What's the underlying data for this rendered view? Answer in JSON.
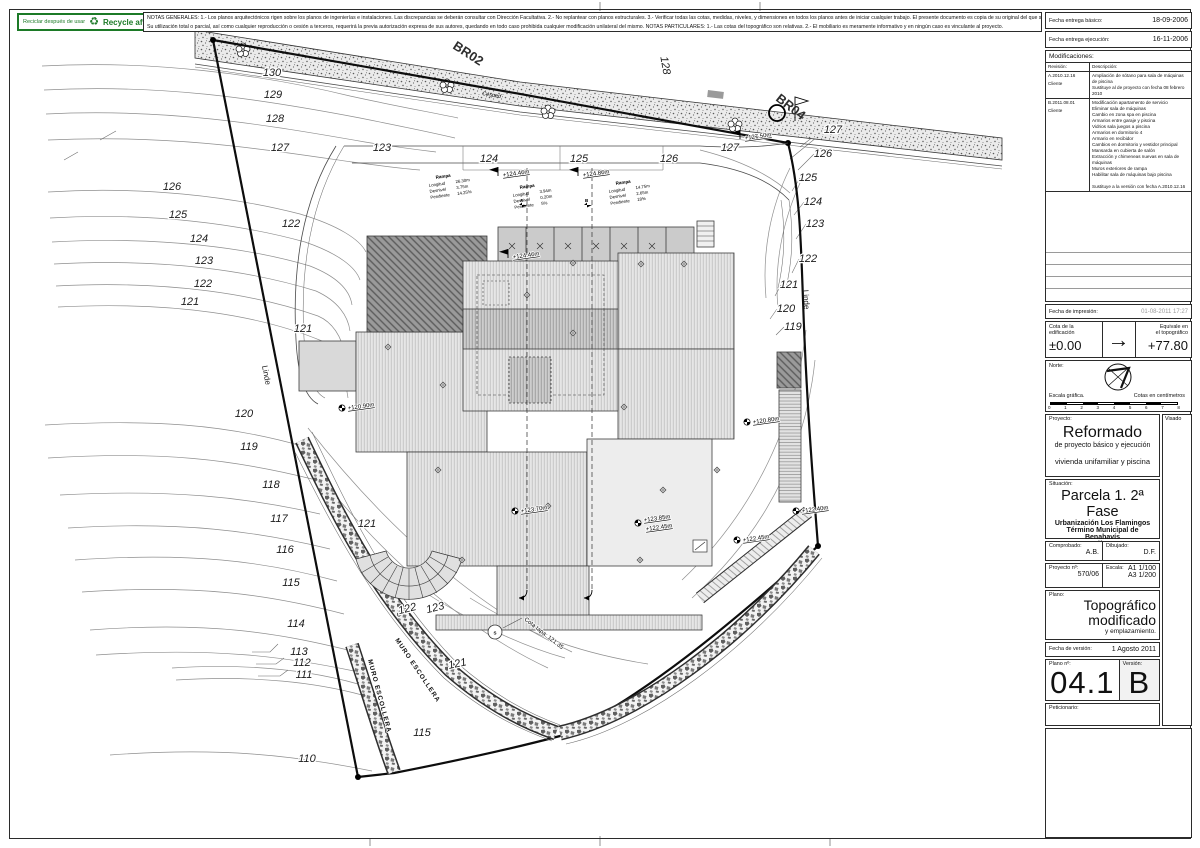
{
  "header": {
    "recycle_es": "Reciclar después de usar",
    "recycle_symbol": "♻",
    "recycle_en": "Recycle after use",
    "notes_line1": "NOTAS GENERALES:  1.- Los planos arquitectónicos rigen sobre los planos de ingenierías e instalaciones. Las discrepancias se deberán consultar con Dirección Facultativa.  2.- No replantear con planos estructurales.  3.- Verificar todas las cotas, medidas, niveles, y dimensiones en todos los planos antes de iniciar cualquier trabajo. El presente documento es copia de su original del que son autores los arquitectos",
    "notes_line2": "Su utilización total o parcial, así como cualquier reproducción o cesión a terceros, requerirá la previa autorización expresa de sus autores, quedando en todo caso prohibida cualquier modificación unilateral del mismo.   NOTAS PARTICULARES:  1.- Las cotas del topográfico son relativas.  2.- El mobiliario es meramente informativo y en ningún caso es vinculante al proyecto."
  },
  "titleblock": {
    "fecha_basico_label": "Fecha entrega básico:",
    "fecha_basico": "18-09-2006",
    "fecha_ejecucion_label": "Fecha entrega ejecución:",
    "fecha_ejecucion": "16-11-2006",
    "modificaciones_label": "Modificaciones:",
    "revision_label": "Revisión:",
    "descripcion_label": "Descripción:",
    "revisions": [
      {
        "rev": "A.2010.12.16",
        "by": "Cliente",
        "desc": "Ampliación de sótano para sala de máquinas de piscina\nSustituye al de proyecto con fecha 08 febrero 2010"
      },
      {
        "rev": "B.2011.08.01",
        "by": "Cliente",
        "desc": "Modificación apartamento de servicio\nEliminar sala de máquinas\nCambio en zona spa en piscina\nArmarios entre garaje y piscina\nVidrios sala juegos a piscina\nArmarios en dormitorio 4\nArmario en recibidor\nCambios en dormitorio y vestidor principal\nMansarda en cubierta de salón\nExtracción y chimeneas nuevas en sala de máquinas\nMuros exteriores de rampa\nHabilitar sala de máquinas bajo piscina\n\nSustituye a la versión con fecha A.2010.12.16"
      }
    ],
    "fecha_impresion_label": "Fecha de impresión:",
    "fecha_impresion": "01-08-2011 17:27",
    "cota_label1": "Cota de la",
    "cota_label2": "edificación",
    "cota_value": "±0.00",
    "arrow": "→",
    "equivale_label1": "Equivale en",
    "equivale_label2": "el topográfico",
    "equivale_value": "+77.80",
    "norte_label": "Norte:",
    "escala_grafica_label": "Escala gráfica.",
    "cotas_cm_label": "Cotas en centímetros",
    "scale_ticks": [
      "0",
      "1",
      "2",
      "3",
      "4",
      "5",
      "6",
      "7",
      "8"
    ],
    "proyecto_label": "Proyecto:",
    "visado_label": "Visado",
    "proyecto_title": "Reformado",
    "proyecto_sub1": "de proyecto básico y ejecución",
    "proyecto_sub2": "vivienda unifamiliar y piscina",
    "situacion_label": "Situación:",
    "situacion_title": "Parcela 1. 2ª Fase",
    "situacion_sub1": "Urbanización Los Flamingos",
    "situacion_sub2": "Término Municipal de Benahavís",
    "situacion_sub3": "Málaga",
    "comprobado_label": "Comprobado:",
    "comprobado": "A.B.",
    "dibujado_label": "Dibujado:",
    "dibujado": "D.F.",
    "proyecto_num_label": "Proyecto nº:",
    "proyecto_num": "570/06",
    "escala_label": "Escala:",
    "escala1": "A1 1/100",
    "escala2": "A3 1/200",
    "plano_label": "Plano:",
    "plano_title1": "Topográfico",
    "plano_title2": "modificado",
    "plano_sub": "y emplazamiento.",
    "fecha_version_label": "Fecha de versión:",
    "fecha_version": "1 Agosto 2011",
    "plano_num_label": "Plano nº:",
    "plano_num": "04.1",
    "version_label": "Versión:",
    "version": "B",
    "peticionario_label": "Peticionario:"
  },
  "plan": {
    "br02": "BR02",
    "br04": "BR04",
    "cesped": "Césped",
    "linde_left": "Linde",
    "linde_right": "Linde",
    "muro_1": "MURO ESCOLLERA",
    "muro_2": "MURO ESCOLLERA",
    "section_a": "A",
    "section_b": "B",
    "s_marker": "S",
    "cota_tapa": "Cota tapa: 121.35",
    "contour_labels": [
      "130",
      "129",
      "128",
      "127",
      "126",
      "125",
      "124",
      "123",
      "122",
      "121",
      "122",
      "121",
      "120",
      "119",
      "118",
      "117",
      "116",
      "115",
      "114",
      "113",
      "112",
      "111",
      "110",
      "127",
      "126",
      "125",
      "124",
      "123",
      "122",
      "121",
      "120",
      "119",
      "124",
      "125",
      "126",
      "127",
      "123",
      "121",
      "122",
      "123",
      "121",
      "115",
      "128"
    ],
    "spot_elevations": [
      "+124.46m",
      "+124.86m",
      "+124.46m",
      "+127.50m",
      "+120.90m",
      "+120.80m",
      "+123.70m",
      "+123.85m",
      "+122.45m",
      "+122.45m",
      "+122.40m"
    ],
    "ramp_tables": [
      {
        "title": "Rampa",
        "rows": [
          [
            "Longitud",
            "26.30m"
          ],
          [
            "Desnivel",
            "3.75m"
          ],
          [
            "Pendiente",
            "14.25%"
          ]
        ]
      },
      {
        "title": "Rampa",
        "rows": [
          [
            "Longitud",
            "3.94m"
          ],
          [
            "Desnivel",
            "0.20m"
          ],
          [
            "Pendiente",
            "5%"
          ]
        ]
      },
      {
        "title": "Rampa",
        "rows": [
          [
            "Longitud",
            "14.75m"
          ],
          [
            "Desnivel",
            "2.65m"
          ],
          [
            "Pendiente",
            "18%"
          ]
        ]
      }
    ]
  }
}
